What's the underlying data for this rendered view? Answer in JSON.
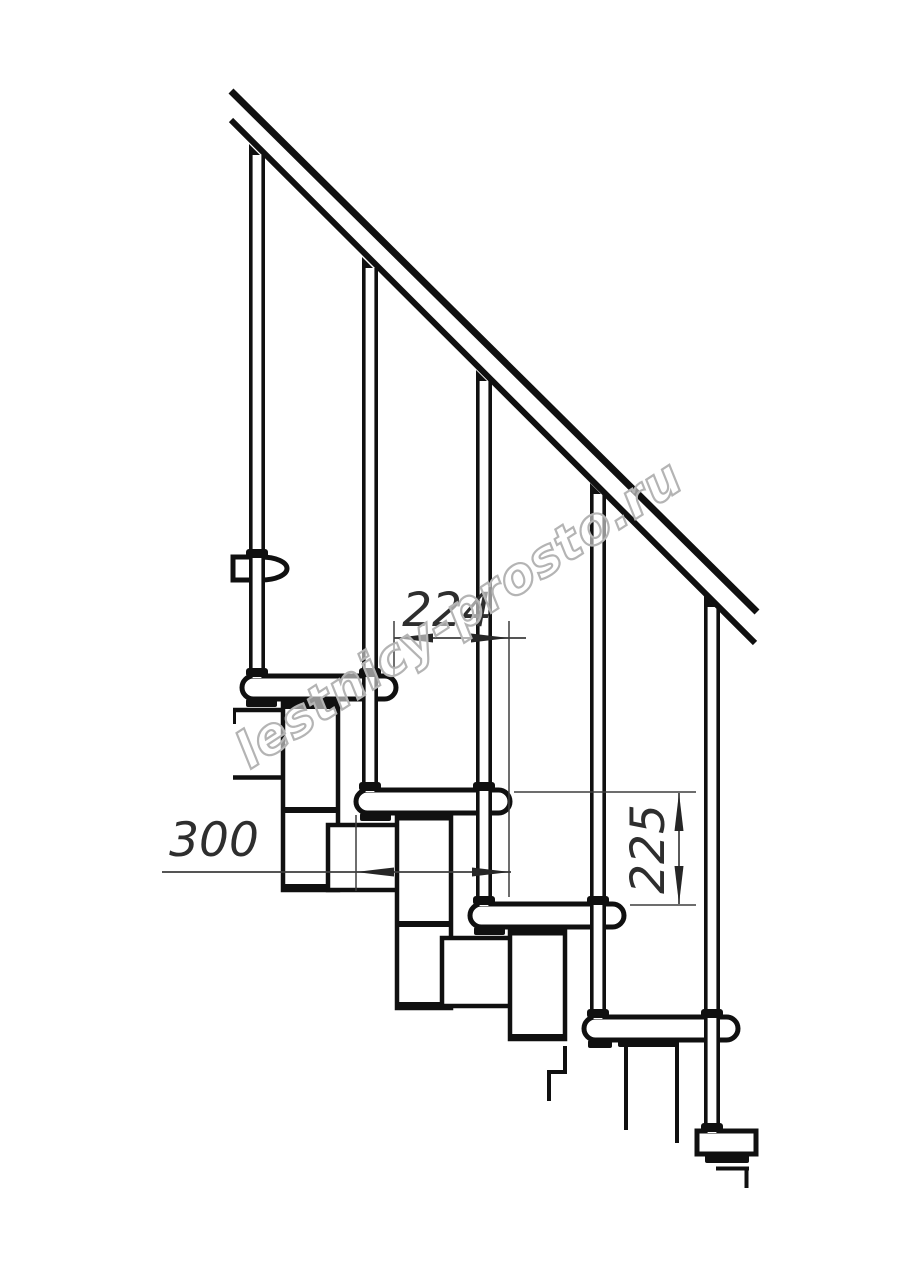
{
  "drawing": {
    "type": "technical-line-drawing",
    "subject": "modular staircase side elevation with handrail, balusters, treads and support modules",
    "dimensions": {
      "tread_spacing": "224",
      "tread_length": "300",
      "riser_height": "225"
    },
    "watermark": {
      "text": "lestnicy-prosto.ru"
    },
    "colors": {
      "line": "#101010",
      "dimension": "#3d3d3d",
      "dimension_text": "#2e2e2e",
      "watermark_outline": "#b4b4b4",
      "background": "#ffffff"
    }
  }
}
